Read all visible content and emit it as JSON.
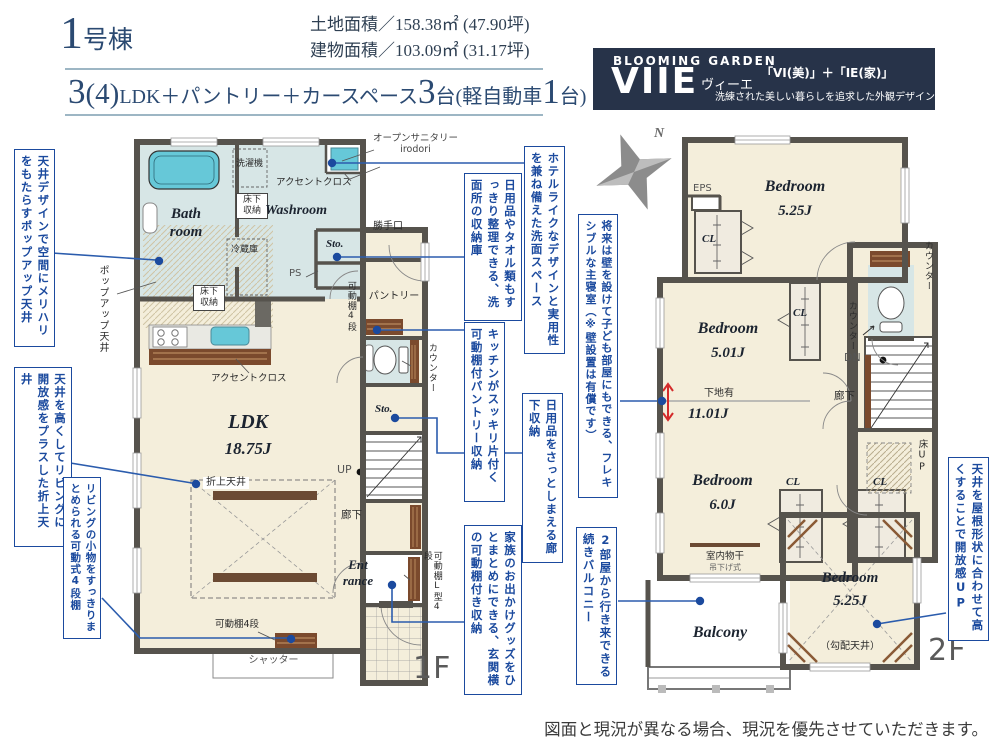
{
  "header": {
    "building_no": "1",
    "building_suffix": "号棟",
    "land_area": "土地面積／158.38㎡ (47.90坪)",
    "building_area": "建物面積／103.09㎡ (31.17坪)",
    "plan": {
      "rooms_big": "3",
      "rooms_paren": "(4)",
      "desc": "LDK＋パントリー＋カースペース",
      "cars_big": "3",
      "cars_unit": "台",
      "kei_pre": "(軽自動車",
      "kei_big": "1",
      "kei_post": "台)"
    }
  },
  "logo": {
    "brand": "BLOOMING GARDEN",
    "name": "VIIE",
    "kana": "ヴィーエ",
    "formula": "「VI(美)」＋「IE(家)」",
    "tagline": "洗練された美しい暮らしを追求した外観デザイン"
  },
  "compass": {
    "north": "N"
  },
  "floor1": {
    "floor_label": "1F",
    "bath": "Bath\nroom",
    "washroom": "Washroom",
    "washer": "洗濯機",
    "underfloor_a": "床下\n収納",
    "underfloor_b": "床下\n収納",
    "accent_a": "アクセントクロス",
    "accent_b": "アクセントクロス",
    "open_sanitary": "オープンサニタリー\nirodori",
    "sto_a": "Sto.",
    "ps": "PS",
    "back_door": "勝手口",
    "pantry": "パントリー",
    "fridge": "冷蔵庫",
    "popup_ceiling": "ポップアップ天井",
    "shelf_4a": "可動棚4段",
    "counter": "カウンター",
    "sto_b": "Sto.",
    "ldk_name": "LDK",
    "ldk_size": "18.75J",
    "up": "UP",
    "raised_ceiling": "折上天井",
    "hallway": "廊下",
    "entrance": "Ent\nrance",
    "shelf_L": "可動棚L型4段",
    "shelf_4b": "可動棚4段",
    "shutter": "シャッター"
  },
  "floor2": {
    "floor_label": "2F",
    "bedroom1_name": "Bedroom",
    "bedroom1_size": "5.25J",
    "eps": "EPS",
    "cl1": "CL",
    "cl2": "CL",
    "cl3": "CL",
    "cl4": "CL",
    "counter_a": "カウンター",
    "counter_b": "カウンター",
    "dn": "DN",
    "bedroom2_name": "Bedroom",
    "bedroom2_size": "5.01J",
    "shitaji": "下地有",
    "combined_size": "11.01J",
    "hallway": "廊下",
    "bedroom3_name": "Bedroom",
    "bedroom3_size": "6.0J",
    "monohoshi": "室内物干",
    "monohoshi_sub": "吊下げ式",
    "floor_up": "床UP",
    "bedroom4_name": "Bedroom",
    "bedroom4_size": "5.25J",
    "sloped_ceiling": "（勾配天井）",
    "balcony": "Balcony"
  },
  "callouts": {
    "popup_ceiling": "天井デザインで空間にメリハリをもたらすポップアップ天井",
    "raised_ceiling": "天井を高くしてリビングに開放感をプラスした折上天井",
    "movable_shelf": "リビングの小物をすっきりまとめられる可動式4段棚",
    "wash_space": "ホテルライクなデザインと実用性を兼ね備えた洗面スペース",
    "wash_storage": "日用品やタオル類もすっきり整理できる、洗面所の収納庫",
    "pantry_storage": "キッチンがスッキリ片付く可動棚付パントリー収納",
    "hall_storage": "日用品をさっとしまえる廊下収納",
    "entrance_storage": "家族のお出かけグッズをひとまとめにできる、玄関横の可動棚付き収納",
    "flexible_bedroom": "将来は壁を設けて子ども部屋にもできる、フレキシブルな主寝室（※壁設置は有償です）",
    "balcony": "2部屋から行き来できる続きバルコニー",
    "high_ceiling": "天井を屋根形状に合わせて高くすることで開放感UP"
  },
  "footer": {
    "note": "図面と現況が異なる場合、現況を優先させていただきます。"
  },
  "colors": {
    "accent_blue": "#1b4a9e",
    "navy": "#2b4a72",
    "logo_bg": "#273349",
    "floor": "#f4eedb",
    "wet_blue": "#d7e6e6",
    "wall": "#56534d",
    "wood": "#7b4a2d",
    "fixture_cyan": "#66c8d8",
    "red": "#d42b2b"
  }
}
